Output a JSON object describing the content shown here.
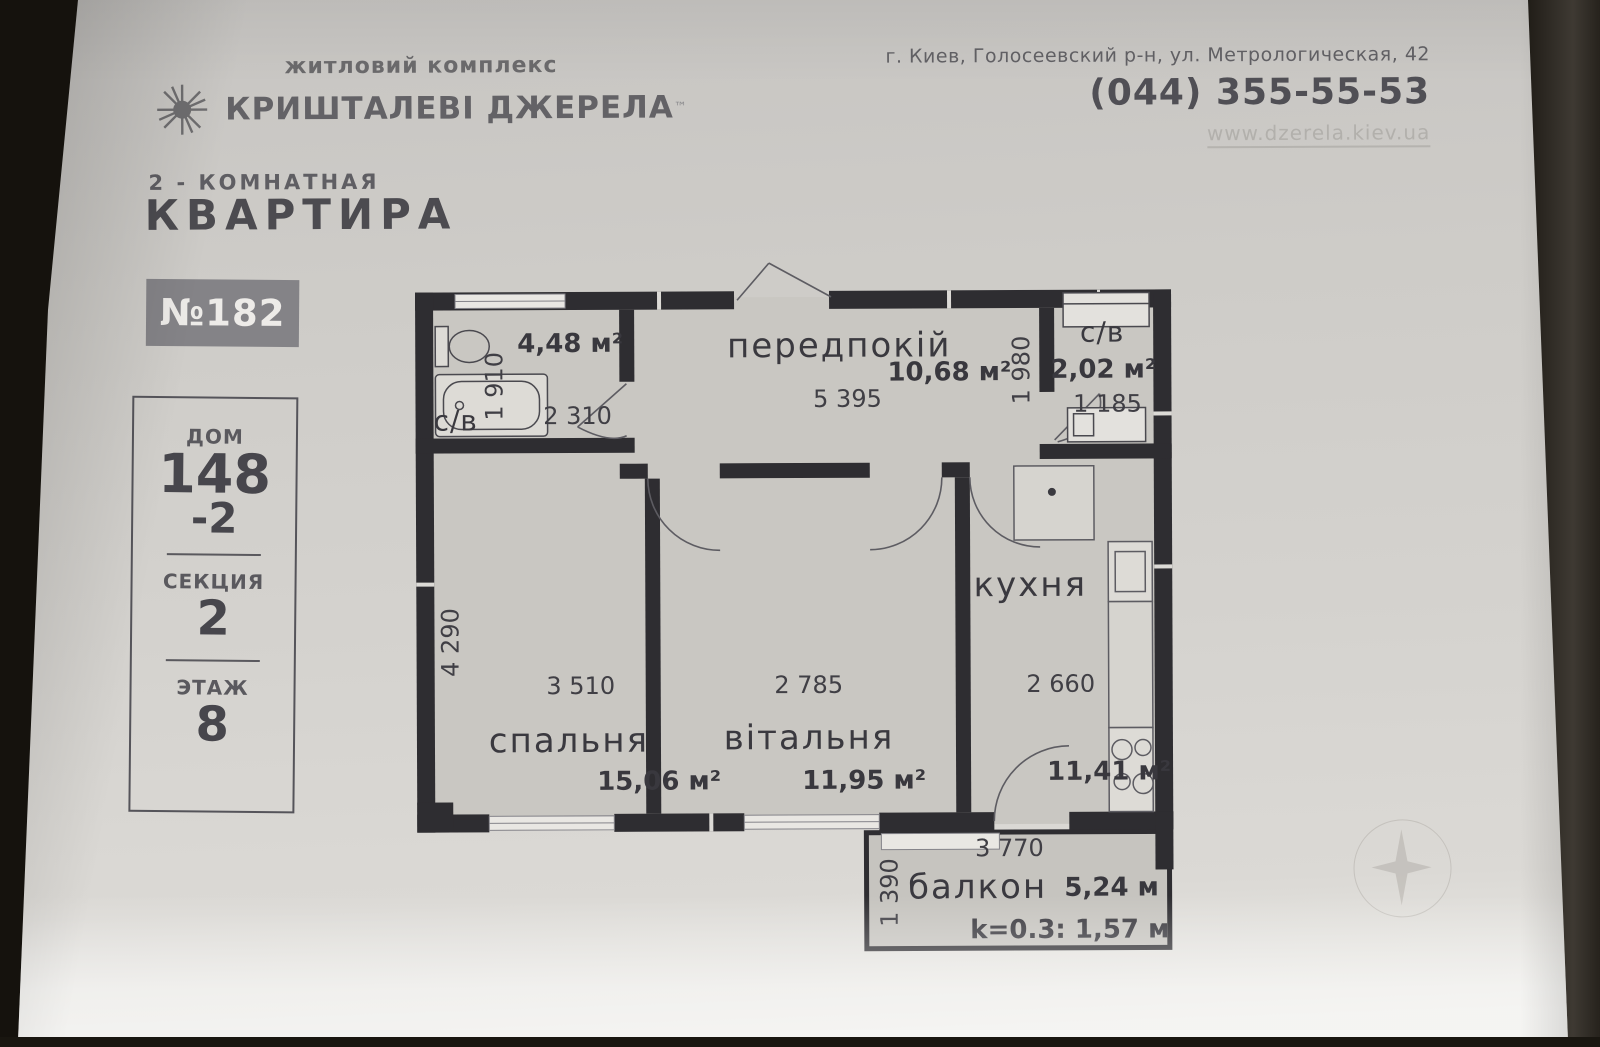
{
  "header": {
    "logo_subtitle": "житловий комплекс",
    "logo_title": "КРИШТАЛЕВІ ДЖЕРЕЛА",
    "logo_tm": "™",
    "address": "г. Киев, Голосеевский р-н, ул. Метрологическая, 42",
    "phone": "(044) 355-55-53",
    "website": "www.dzerela.kiev.ua"
  },
  "apartment": {
    "type_line": "2 - КОМНАТНАЯ",
    "title": "КВАРТИРА",
    "number": "№182",
    "house_label": "ДОМ",
    "house_value": "148",
    "house_value2": "-2",
    "section_label": "СЕКЦИЯ",
    "section_value": "2",
    "floor_label": "ЭТАЖ",
    "floor_value": "8"
  },
  "plan": {
    "rooms": {
      "bathroom1": {
        "label": "с/в",
        "area": "4,48 м²",
        "dim_v": "1 910",
        "dim_h": "2 310"
      },
      "hallway": {
        "label": "передпокій",
        "area": "10,68 м²",
        "dim_h": "5 395",
        "dim_v": "1 980"
      },
      "bathroom2": {
        "label": "с/в",
        "area": "2,02 м²",
        "dim_h": "1 185"
      },
      "bedroom": {
        "label": "спальня",
        "area": "15,06 м²",
        "dim_h": "3 510",
        "dim_v": "4 290"
      },
      "living": {
        "label": "вітальня",
        "area": "11,95 м²",
        "dim_h": "2 785"
      },
      "kitchen": {
        "label": "кухня",
        "area": "11,41 м²",
        "dim_h": "2 660"
      },
      "balcony": {
        "label": "балкон",
        "area": "5,24 м",
        "dim_h": "3 770",
        "dim_v": "1 390",
        "coefficient": "k=0.3: 1,57 м"
      }
    }
  },
  "colors": {
    "paper": "#d4d2ce",
    "wall": "#2e2d31",
    "badge": "#848387",
    "title_text": "#4c4b50"
  }
}
